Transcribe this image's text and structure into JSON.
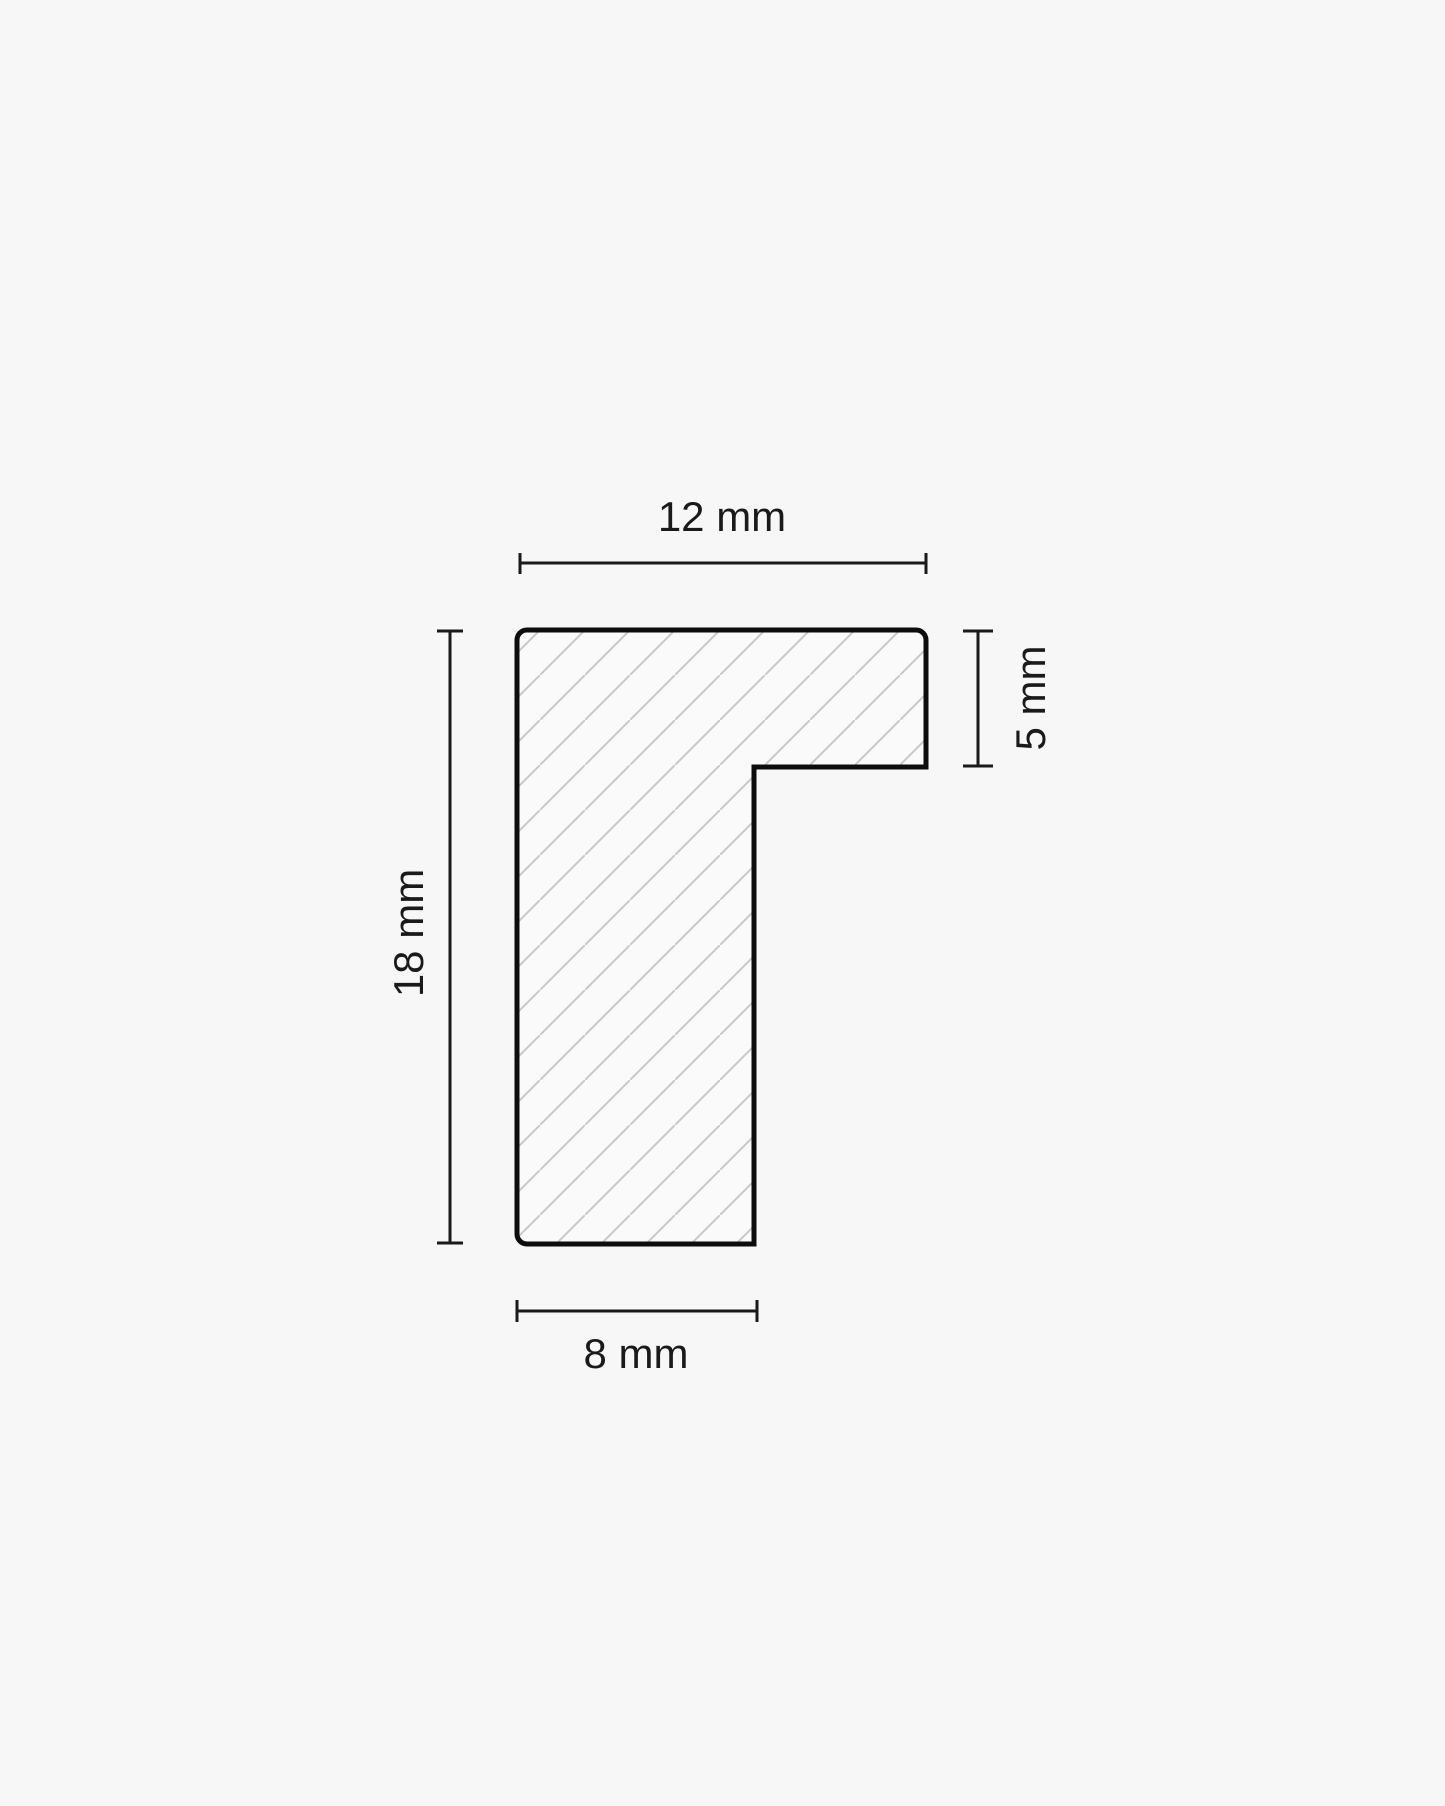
{
  "diagram": {
    "kind": "profile-cross-section",
    "dimensions": {
      "top_width": {
        "label": "12 mm",
        "value": 12,
        "unit": "mm",
        "orientation": "horizontal"
      },
      "left_height": {
        "label": "18 mm",
        "value": 18,
        "unit": "mm",
        "orientation": "vertical"
      },
      "right_rabbet": {
        "label": "5 mm",
        "value": 5,
        "unit": "mm",
        "orientation": "vertical"
      },
      "bottom_width": {
        "label": "8 mm",
        "value": 8,
        "unit": "mm",
        "orientation": "horizontal"
      }
    },
    "colors": {
      "background": "#f7f7f8",
      "profile_fill": "#fafafa",
      "outline": "#0d0d0d",
      "hatch": "#c9c9cc",
      "dimension_line": "#1a1a1a",
      "text": "#1a1a1a"
    }
  }
}
